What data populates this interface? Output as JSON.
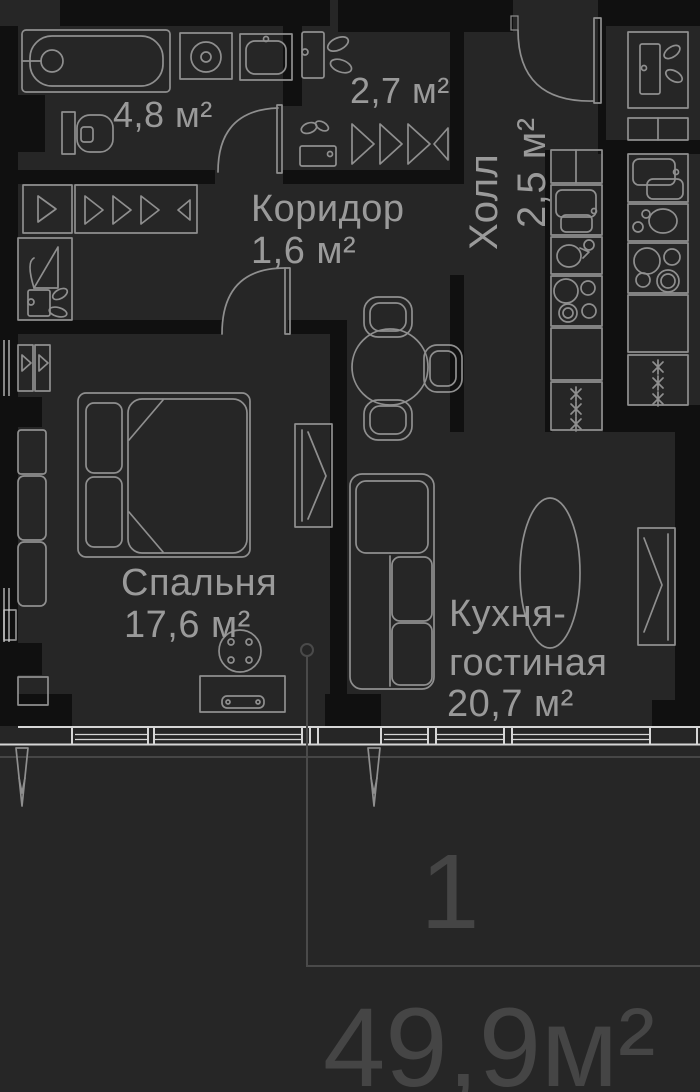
{
  "unit": {
    "rooms_count": "1",
    "total_area": "49,9м²"
  },
  "rooms": {
    "bathroom": {
      "area": "4,8 м²"
    },
    "wardrobe": {
      "area": "2,7 м²"
    },
    "hall": {
      "name": "Холл",
      "area": "2,5 м²"
    },
    "corridor": {
      "name": "Коридор",
      "area": "1,6 м²"
    },
    "bedroom": {
      "name": "Спальня",
      "area": "17,6 м²"
    },
    "kitchen_living": {
      "name_line_1": "Кухня-",
      "name_line_2": "гостиная",
      "area": "20,7 м²"
    }
  },
  "colors": {
    "background": "#262626",
    "walls": "#101010",
    "fixtures": "#8f8f8f",
    "labels": "#9a9a9a",
    "windows": "#d6d6d6",
    "annotation": "#454545"
  }
}
